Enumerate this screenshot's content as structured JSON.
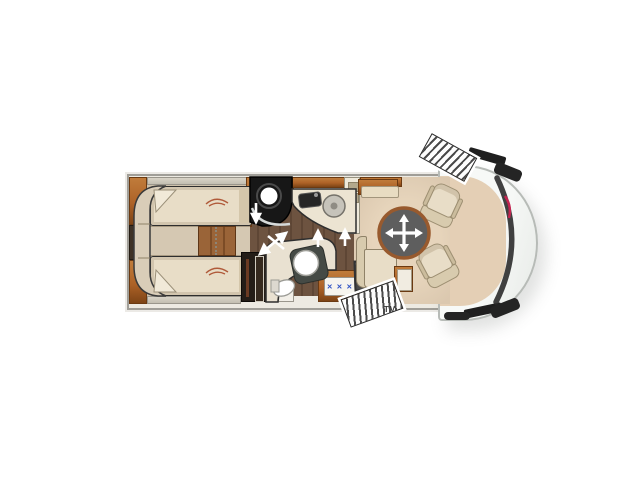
{
  "floorplan": {
    "vehicle": "motorhome-floorplan-top-view",
    "tv_label": "TV",
    "rooms": [
      "rear-twin-bedroom",
      "shower-room",
      "kitchen",
      "wardrobe",
      "bathroom",
      "lounge-dinette",
      "driver-cab"
    ],
    "icons": {
      "hob_burners_glyph": "✕ ✕ ✕",
      "table_move": "four-way-arrow",
      "door_swing": "white-arrow",
      "entry_steps": "hatched-steps"
    },
    "colors": {
      "shell_bg": "#edeae2",
      "wall_gray": "#a09e98",
      "cab_edge": "#b7bbb7",
      "wood": "#ad6227",
      "wood_dark": "#7d4416",
      "wood_light": "#c07c3b",
      "floor_hall": "#6d5340",
      "floor_bedroom": "#cec1ab",
      "floor_lounge": "#dbc8af",
      "upholstery": "#e8ddc7",
      "upholstery_dark": "#d4c6aa",
      "outline_dark": "#2e2e2e",
      "shower_dark": "#171717",
      "table_gray": "#5e5e5e",
      "table_rim": "#985a2e",
      "burner_blue": "#2d51c4",
      "tv_gray": "#4b4b4b",
      "accent_red": "#c32450",
      "step_dark": "#4a4a4a"
    }
  }
}
